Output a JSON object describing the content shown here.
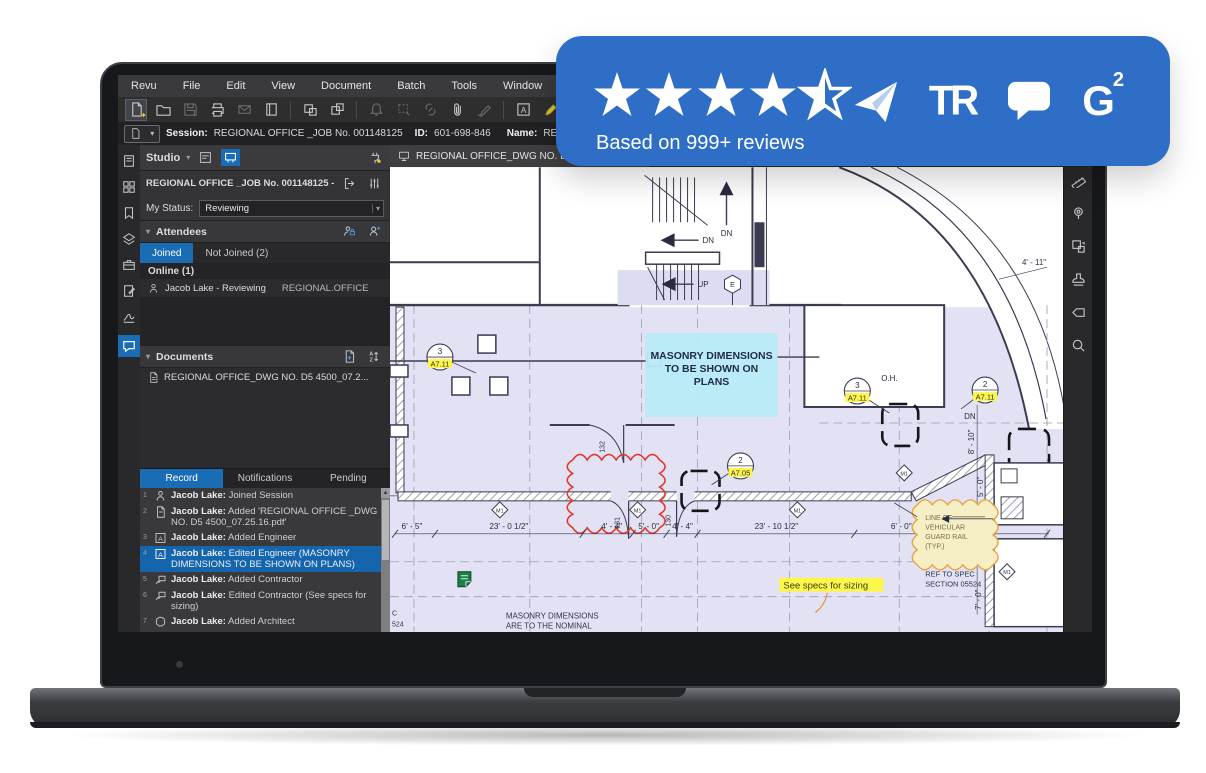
{
  "badge": {
    "rating": "4.5",
    "caption": "Based on 999+ reviews",
    "logo_tr": "TR",
    "logo_g2_g": "G",
    "logo_g2_two": "2"
  },
  "menu": {
    "items": [
      "Revu",
      "File",
      "Edit",
      "View",
      "Document",
      "Batch",
      "Tools",
      "Window",
      "Help"
    ]
  },
  "session_bar": {
    "session_label": "Session:",
    "session_value": "REGIONAL OFFICE _JOB No. 001148125",
    "id_label": "ID:",
    "id_value": "601-698-846",
    "name_label": "Name:",
    "name_value": "REGIONAL OFFICE_DWG NO."
  },
  "studio": {
    "title": "Studio",
    "session_title": "REGIONAL OFFICE _JOB No. 001148125 - 601-69",
    "status_label": "My Status:",
    "status_value": "Reviewing",
    "attendees_header": "Attendees",
    "tab_joined": "Joined",
    "tab_not_joined": "Not Joined (2)",
    "online_header": "Online (1)",
    "attendee_name": "Jacob Lake - Reviewing",
    "attendee_org": "REGIONAL.OFFICE",
    "documents_header": "Documents",
    "document_name": "REGIONAL OFFICE_DWG NO. D5 4500_07.2...",
    "tab_record": "Record",
    "tab_notifications": "Notifications",
    "tab_pending": "Pending",
    "records": [
      {
        "num": "1",
        "user": "Jacob Lake:",
        "action": "Joined Session"
      },
      {
        "num": "2",
        "user": "Jacob Lake:",
        "action": "Added 'REGIONAL OFFICE _DWG NO. D5 4500_07.25.16.pdf'"
      },
      {
        "num": "3",
        "user": "Jacob Lake:",
        "action": "Added Engineer"
      },
      {
        "num": "4",
        "user": "Jacob Lake:",
        "action": "Edited Engineer (MASONRY DIMENSIONS TO BE SHOWN ON PLANS)"
      },
      {
        "num": "5",
        "user": "Jacob Lake:",
        "action": "Added Contractor"
      },
      {
        "num": "6",
        "user": "Jacob Lake:",
        "action": "Edited Contractor (See specs for sizing)"
      },
      {
        "num": "7",
        "user": "Jacob Lake:",
        "action": "Added Architect"
      }
    ]
  },
  "doc_tab": {
    "label": "REGIONAL OFFICE_DWG NO. D5 4500"
  },
  "plan": {
    "note_lines": [
      "MASONRY DIMENSIONS",
      "TO BE SHOWN ON",
      "PLANS"
    ],
    "callouts": [
      {
        "num": "3",
        "sheet": "A7.11"
      },
      {
        "num": "3",
        "sheet": "A7.11"
      },
      {
        "num": "2",
        "sheet": "A7.11"
      },
      {
        "num": "2",
        "sheet": "A7.05"
      }
    ],
    "oh": "O.H.",
    "dn": "DN",
    "up": "UP",
    "stair_elev": "E",
    "doors": [
      "132",
      "131",
      "130"
    ],
    "wall_tag": "M1",
    "dims_bottom": [
      "6' - 5\"",
      "23' - 0 1/2\"",
      "4' - 4\"",
      "5' - 0\"",
      "4' - 4\"",
      "23' - 10 1/2\"",
      "6' - 0\""
    ],
    "dims_right": [
      "8' - 10\"",
      "5' - 0\"",
      "10' - 0\"",
      "7' - 0\""
    ],
    "dim_top_right": "4' - 11\"",
    "guard_note": [
      "LINE OF",
      "VEHICULAR",
      "GUARD RAIL",
      "(TYP.)"
    ],
    "spec_ref": [
      "REF TO SPEC",
      "SECTION 05524"
    ],
    "specs_note": "See specs for sizing",
    "bottom_note": [
      "MASONRY DIMENSIONS",
      "ARE TO THE NOMINAL",
      "FACE OF MASONRY"
    ],
    "left_partial": [
      "C",
      "524"
    ]
  },
  "colors": {
    "accent": "#1a6cb5",
    "badge_blue": "#2e6ec7",
    "selection": "#1565ad",
    "cloud_red": "#e0392e",
    "cloud_orange": "#e8a33d",
    "highlight_yellow": "#fdf74b",
    "highlight_cyan": "#b7ebf7"
  }
}
